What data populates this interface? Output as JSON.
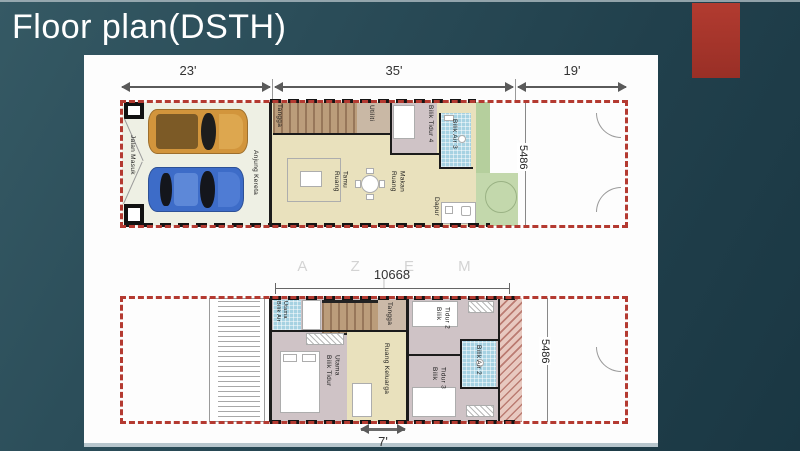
{
  "slide": {
    "title": "Floor plan(DSTH)"
  },
  "watermark": "A Z E M I",
  "colors": {
    "background_teal": "#2b4d59",
    "accent_red": "#a8362d",
    "boundary_red": "#b43a31",
    "floor_cream": "#e9e1bd",
    "bedroom_mauve": "#cfc3c6",
    "bathroom_blue": "#a6d2e2",
    "grass_green": "#b5cf9d"
  },
  "ground_floor": {
    "dim_front": "23'",
    "dim_house": "35'",
    "dim_back": "19'",
    "dim_depth": "5486",
    "rooms": {
      "jalan_masuk": "Jalan Masuk",
      "anjung_kereta": "Anjung Kereta",
      "tangga": "Tangga",
      "utiliti": "Utiliti",
      "ruang_tamu": "Ruang Tamu",
      "ruang_makan": "Ruang Makan",
      "bilik_tidur_4": "Bilik Tidur 4",
      "bilik_air_3": "Bilik Air 3",
      "dapur": "Dapur"
    }
  },
  "first_floor": {
    "dim_width": "10668",
    "dim_depth": "5486",
    "dim_front": "7'",
    "rooms": {
      "bilik_air_utama": "Bilik Air Utama",
      "tangga": "Tangga",
      "bilik_tidur_utama": "Bilik Tidur Utama",
      "ruang_keluarga": "Ruang Keluarga",
      "bilik_tidur_2": "Bilik Tidur 2",
      "bilik_air_2": "Bilik Air 2",
      "bilik_tidur_3": "Bilik Tidur 3"
    }
  }
}
